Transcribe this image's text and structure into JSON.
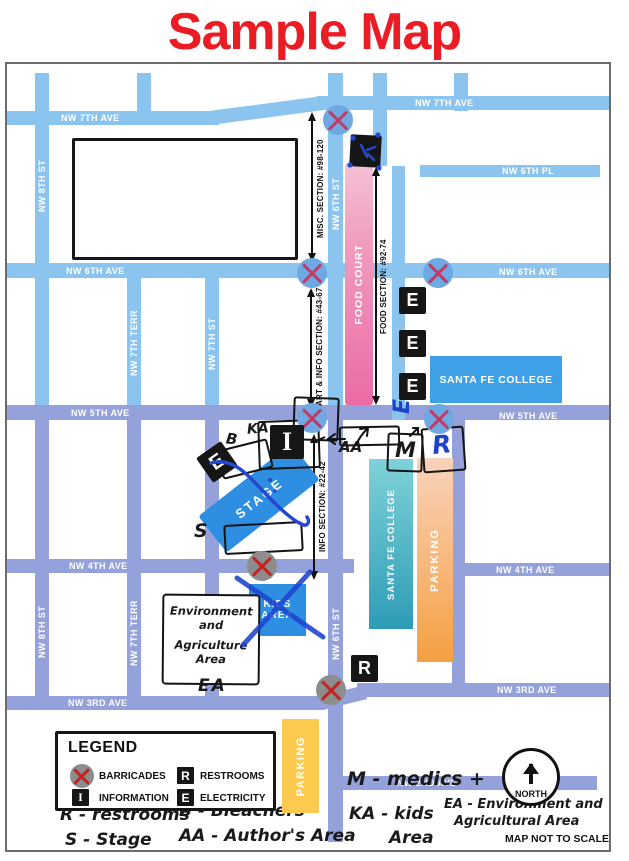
{
  "title": "Sample Map",
  "colors": {
    "title_red": "#ec1c24",
    "street_blue": "#8bc4ee",
    "street_purple": "#94a1db",
    "food_court_pink": "#ec6ba6",
    "college_blue": "#3ea1e8",
    "college_teal": "#2d9cb6",
    "parking_orange": "#f5a041",
    "parking_yellow": "#fbca4e",
    "kids_stage_blue": "#2e8fe2",
    "barricade_blue": "#6fa9e3",
    "barricade_gray": "#8d8d8d",
    "marker_black": "#161616",
    "pen_blue": "#1e43c8"
  },
  "streets": {
    "nw_7th_ave": "NW 7TH AVE",
    "nw_6th_pl": "NW 6TH PL",
    "nw_6th_ave": "NW 6TH AVE",
    "nw_5th_ave": "NW 5TH AVE",
    "nw_4th_ave": "NW 4TH AVE",
    "nw_3rd_ave": "NW 3RD AVE",
    "nw_2nd_ave": "NW 2ND AVE",
    "nw_8th_st": "NW 8TH ST",
    "nw_7th_terr": "NW 7TH TERR",
    "nw_7th_st": "NW 7TH ST",
    "nw_6th_st": "NW 6TH ST"
  },
  "sections": {
    "misc": "MISC. SECTION: #98-120",
    "food": "FOOD SECTION: #92-74",
    "art_info": "ART & INFO SECTION: #43-67",
    "info": "INFO SECTION: #22-42"
  },
  "areas": {
    "food_court": "FOOD COURT",
    "santa_fe_college": "SANTA FE COLLEGE",
    "parking": "PARKING",
    "kids_line1": "KIDS",
    "kids_line2": "AREA",
    "stage": "STAGE",
    "env_line1": "Environment",
    "env_line2": "and",
    "env_line3": "Agriculture",
    "env_line4": "Area"
  },
  "markers": {
    "electricity": "E",
    "information": "I",
    "restrooms": "R",
    "medics": "M"
  },
  "handwritten": {
    "ka": "KA",
    "b": "B",
    "s": "S",
    "aa": "AA",
    "m": "M",
    "r": "R",
    "e_rotated": "E",
    "ea": "EA",
    "note_r": "R - restrooms",
    "note_b": "B - Bleachers",
    "note_s": "S - Stage",
    "note_aa": "AA - Author's Area",
    "note_m": "M - medics +",
    "note_ka_1": "KA - kids",
    "note_ka_2": "Area",
    "note_ea_1": "EA - Environment and",
    "note_ea_2": "Agricultural Area"
  },
  "legend": {
    "title": "LEGEND",
    "items": [
      {
        "symbol": "barricade",
        "label": "BARRICADES"
      },
      {
        "symbol": "I",
        "label": "INFORMATION"
      },
      {
        "symbol": "R",
        "label": "RESTROOMS"
      },
      {
        "symbol": "E",
        "label": "ELECTRICITY"
      }
    ]
  },
  "compass": {
    "label": "NORTH"
  },
  "footer": {
    "scale_note": "MAP NOT TO SCALE"
  }
}
